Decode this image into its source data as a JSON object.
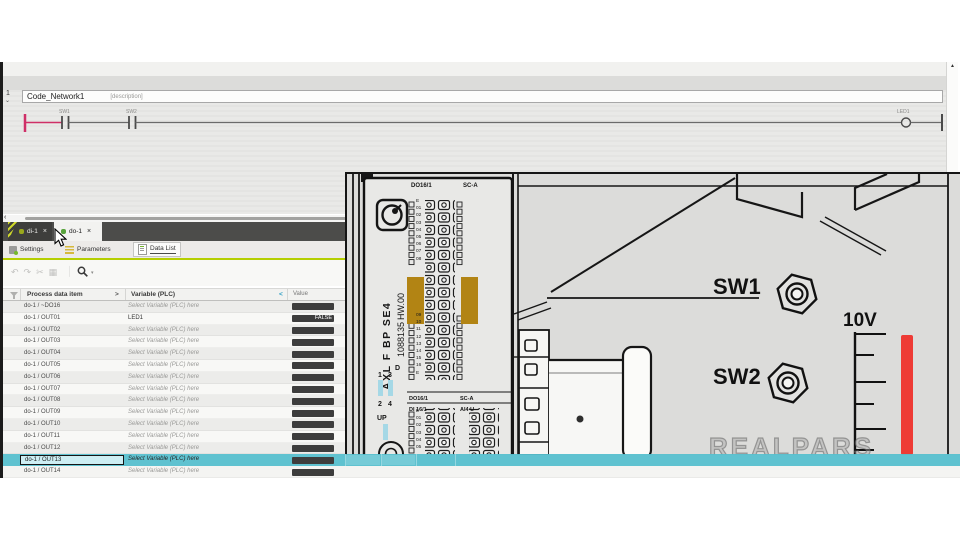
{
  "icons": {
    "close": "×",
    "scroll_up": "▲",
    "scroll_left": "‹",
    "undo": "↶",
    "redo": "↷",
    "cut": "✂",
    "grid": "▦",
    "separator": "│",
    "caret": "▾",
    "sort_gt": ">",
    "sort_lt": "<"
  },
  "ladder": {
    "network_number": "1",
    "network_caret": "⌄",
    "title": "Code_Network1",
    "description": "[description]",
    "contact1": "SW1",
    "contact2": "SW2",
    "coil": "LED1"
  },
  "tabs": [
    {
      "label": "di-1",
      "close": "×"
    },
    {
      "label": "do-1",
      "close": "×"
    }
  ],
  "subtabs": [
    {
      "label": "Settings"
    },
    {
      "label": "Parameters"
    },
    {
      "label": "Data List"
    }
  ],
  "datalist": {
    "columns": {
      "item": "Process data item",
      "variable": "Variable (PLC)",
      "value": "Value"
    },
    "placeholder": "Select Variable (PLC) here",
    "rows": [
      {
        "item": "do-1 / ~DO16"
      },
      {
        "item": "do-1 / OUT01",
        "variable": "LED1",
        "value": "FALSE"
      },
      {
        "item": "do-1 / OUT02"
      },
      {
        "item": "do-1 / OUT03"
      },
      {
        "item": "do-1 / OUT04"
      },
      {
        "item": "do-1 / OUT05"
      },
      {
        "item": "do-1 / OUT06"
      },
      {
        "item": "do-1 / OUT07"
      },
      {
        "item": "do-1 / OUT08"
      },
      {
        "item": "do-1 / OUT09"
      },
      {
        "item": "do-1 / OUT10"
      },
      {
        "item": "do-1 / OUT11"
      },
      {
        "item": "do-1 / OUT12"
      },
      {
        "item": "do-1 / OUT13",
        "selected": true
      },
      {
        "item": "do-1 / OUT14"
      }
    ]
  },
  "overlay": {
    "module": {
      "top_label_left": "DO16/1",
      "top_label_right": "SC-A",
      "side_text": "AXL F BP SE4",
      "order_no": "1088135",
      "hw": "HW.00",
      "led_group1": [
        "E",
        "01",
        "02",
        "03",
        "04",
        "05",
        "06",
        "07",
        "08"
      ],
      "led_group2": [
        "09",
        "10",
        "11",
        "12",
        "13",
        "14",
        "15",
        "16",
        "E"
      ],
      "led_group3": [
        "E",
        "01",
        "02",
        "03",
        "04",
        "05"
      ],
      "divider_left": "DO16/1",
      "divider_right": "SC-A",
      "section2_left": "DI 16/1",
      "section2_right": "AI4 U",
      "dip": {
        "d": "D",
        "n1": "1",
        "n3": "3",
        "n2": "2",
        "n4": "4",
        "up": "UP"
      }
    },
    "sw1": "SW1",
    "sw2": "SW2",
    "voltage": "10V",
    "watermark": "REALPARS"
  },
  "colors": {
    "selection": "#56bfce",
    "accent_green": "#b5ce00",
    "gold": "#b28414",
    "red": "#ee3b35",
    "rail_pink": "#cf2f67"
  }
}
